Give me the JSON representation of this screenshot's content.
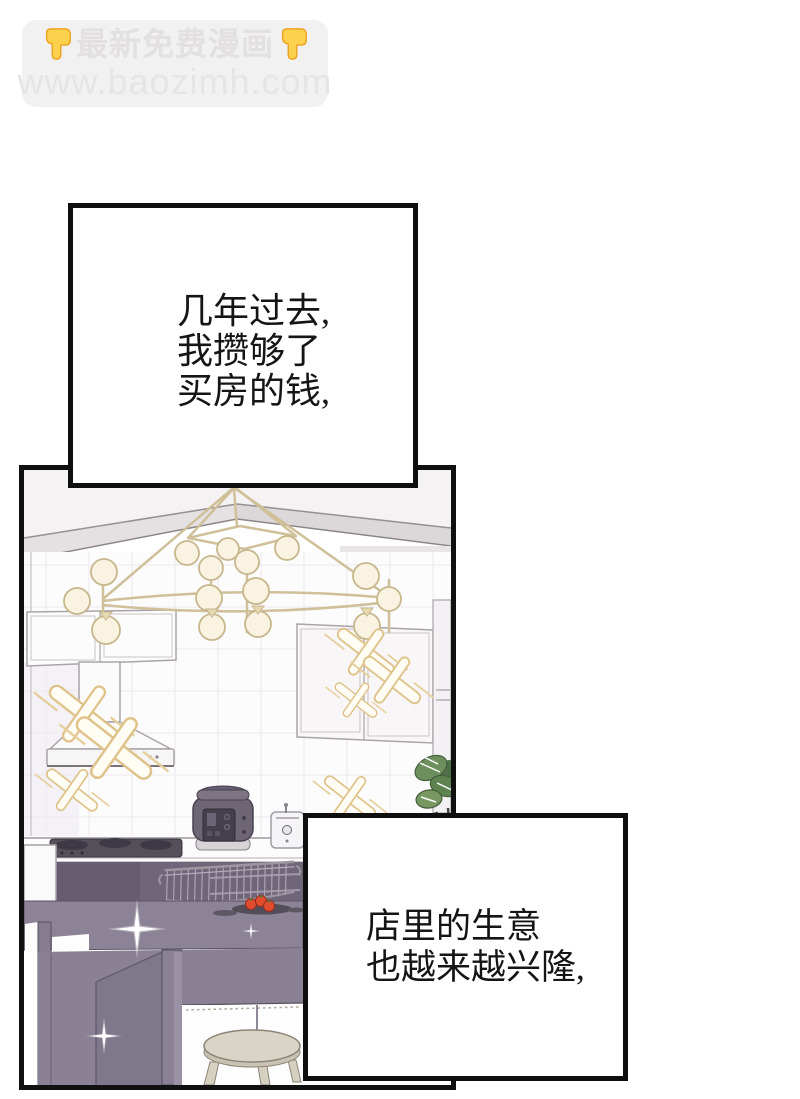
{
  "page": {
    "width": 800,
    "height": 1099,
    "background_color": "#ffffff"
  },
  "watermark": {
    "promo_text": "最新免费漫画",
    "site_url": "www.baozimh.com",
    "background_color": "#f1f1f1",
    "text_color": "#e3e3e3",
    "hand_color": "#fcd24c"
  },
  "narration_boxes": [
    {
      "lines": [
        "几年过去,",
        "我攒够了",
        "买房的钱,"
      ]
    },
    {
      "lines": [
        "店里的生意",
        "也越来越兴隆,"
      ]
    }
  ],
  "panel": {
    "description": "black-and-white manhua panel of a bright kitchen with brass chandelier, range hood, cooktop, rice cooker, toaster, wire basket, tomatoes, dark island table, stool, plant and sparkles",
    "border_color": "#101010",
    "colors": {
      "island_table": "#8a8294",
      "under_counter": "#6f6779",
      "chandelier_metal": "#cfc09a",
      "globe_fill": "#faf3e2",
      "sparkle_gold": "#dfc38b",
      "stool_seat": "#dad4c6",
      "tomato": "#e14b2e",
      "plant_leaf": "#6d8f5e"
    }
  }
}
